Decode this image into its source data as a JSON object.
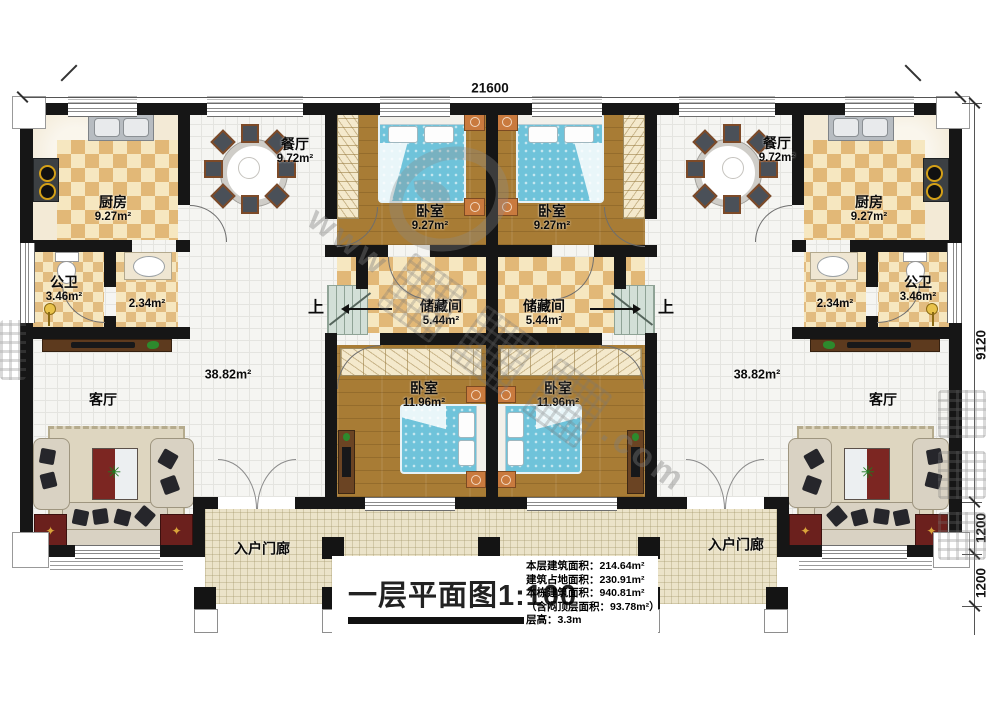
{
  "title": "一层平面图1:100",
  "stats": {
    "floor_area": "本层建筑面积：214.64m²",
    "footprint_area": "建筑占地面积：230.91m²",
    "building_area": "本栋建筑面积：940.81m²",
    "attic_area": "（含闷顶层面积：93.78m²）",
    "floor_height": "层高：3.3m"
  },
  "dimensions": {
    "top_width": "21600",
    "right_main": "9120",
    "right_bay": "1200",
    "right_porch": "1200"
  },
  "rooms": {
    "kitchen": {
      "name": "厨房",
      "area": "9.27m²"
    },
    "dining": {
      "name": "餐厅",
      "area": "9.72m²"
    },
    "bathroom": {
      "name": "公卫",
      "area": "3.46m²"
    },
    "hallway": {
      "area": "2.34m²"
    },
    "bedroom_small": {
      "name": "卧室",
      "area": "9.27m²"
    },
    "storage": {
      "name": "储藏间",
      "area": "5.44m²"
    },
    "bedroom_large": {
      "name": "卧室",
      "area": "11.96m²"
    },
    "living": {
      "name": "客厅",
      "area": "38.82m²"
    },
    "porch": {
      "name": "入户门廊"
    },
    "stairs": {
      "label": "上"
    }
  },
  "watermark": {
    "frag_www": "www",
    "frag_com": ".com"
  }
}
